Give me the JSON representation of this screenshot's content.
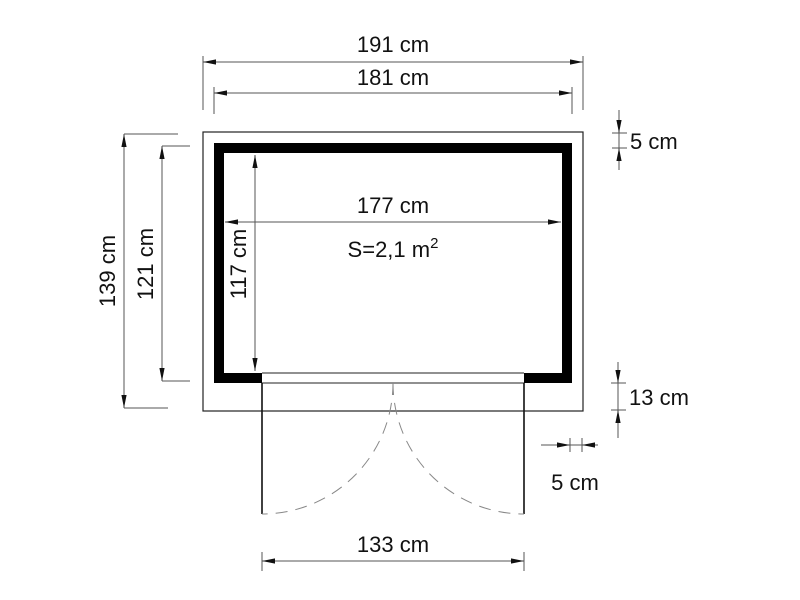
{
  "diagram": {
    "type": "floor-plan",
    "labels": {
      "outer_width": "191 cm",
      "frame_width": "181 cm",
      "inner_width": "177 cm",
      "outer_depth": "139 cm",
      "frame_depth": "121 cm",
      "inner_depth": "117 cm",
      "wall_thickness": "5 cm",
      "front_band_depth": "13 cm",
      "side_overhang": "5 cm",
      "door_width": "133 cm"
    },
    "area": {
      "base": "S=2,1 m",
      "exponent": "2"
    },
    "colors": {
      "outline": "#222222",
      "dimension": "#555555",
      "hatch": "#999999",
      "wall_fill": "#000000",
      "text": "#111111",
      "background": "#ffffff"
    }
  }
}
